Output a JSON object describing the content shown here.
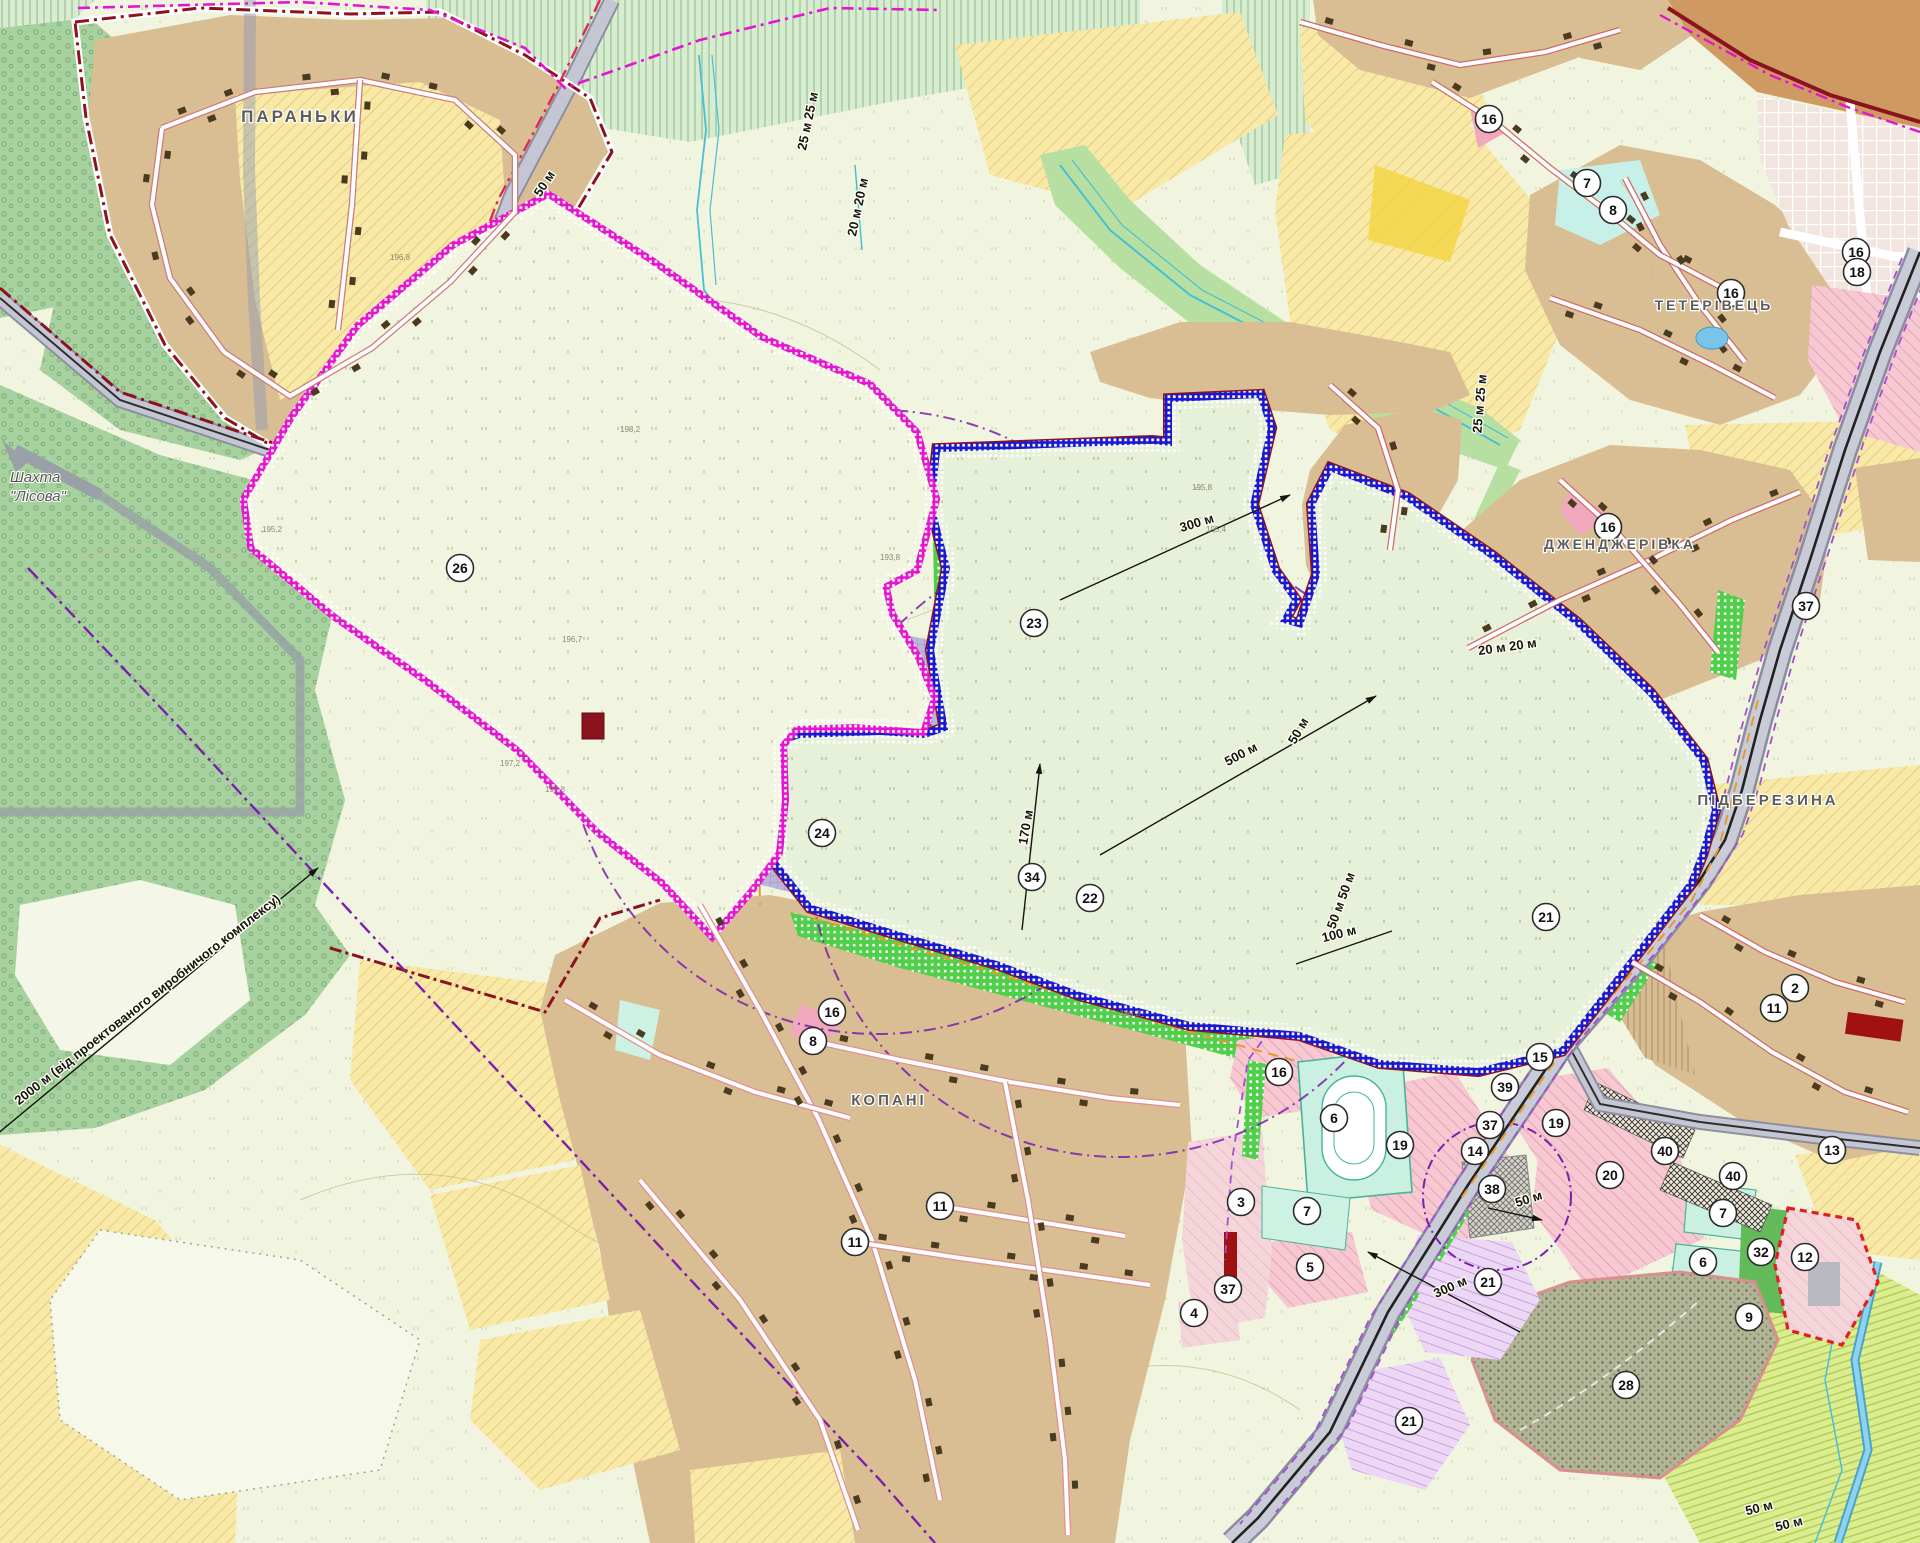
{
  "map": {
    "places": [
      {
        "name": "paranky",
        "text": "ПАРАНЬКИ",
        "x": 300,
        "y": 122,
        "size": 17
      },
      {
        "name": "teterivets",
        "text": "ТЕТЕРІВЕЦЬ",
        "x": 1714,
        "y": 310,
        "size": 14
      },
      {
        "name": "dzhendzherivka",
        "text": "ДЖЕНДЖЕРІВКА",
        "x": 1620,
        "y": 549,
        "size": 14
      },
      {
        "name": "pidberezyna",
        "text": "ПІДБЕРЕЗИНА",
        "x": 1768,
        "y": 805,
        "size": 15
      },
      {
        "name": "kopani",
        "text": "КОПАНІ",
        "x": 889,
        "y": 1105,
        "size": 15
      }
    ],
    "mine_label": {
      "lines": [
        "Шахта",
        "\"Лісова\""
      ],
      "x": 10,
      "y": 482
    },
    "annotations": [
      {
        "text": "50 м",
        "x": 548,
        "y": 186,
        "rot": -57
      },
      {
        "text": "25 м 25 м",
        "x": 812,
        "y": 122,
        "rot": -78
      },
      {
        "text": "20 м 20 м",
        "x": 862,
        "y": 208,
        "rot": -78
      },
      {
        "text": "25 м 25 м",
        "x": 1484,
        "y": 404,
        "rot": -85
      },
      {
        "text": "20 м 20 м",
        "x": 1508,
        "y": 651,
        "rot": -8
      },
      {
        "text": "300 м",
        "x": 1198,
        "y": 527,
        "rot": -17,
        "line": [
          1060,
          600,
          1290,
          495
        ],
        "arrow": true
      },
      {
        "text": "500 м",
        "x": 1243,
        "y": 758,
        "rot": -28,
        "line": [
          1100,
          855,
          1376,
          696
        ],
        "arrow": true
      },
      {
        "text": "170 м",
        "x": 1030,
        "y": 828,
        "rot": -80,
        "line": [
          1022,
          930,
          1040,
          764
        ],
        "arrow": true
      },
      {
        "text": "100 м",
        "x": 1340,
        "y": 938,
        "rot": -14,
        "line": [
          1296,
          964,
          1392,
          931
        ]
      },
      {
        "text": "50 м 50 м",
        "x": 1345,
        "y": 902,
        "rot": -70
      },
      {
        "text": "50 м",
        "x": 1302,
        "y": 733,
        "rot": -60
      },
      {
        "text": "50 м",
        "x": 1530,
        "y": 1203,
        "rot": -18,
        "line": [
          1488,
          1208,
          1542,
          1220
        ],
        "arrow": true
      },
      {
        "text": "300 м",
        "x": 1452,
        "y": 1291,
        "rot": -24,
        "line": [
          1520,
          1332,
          1368,
          1252
        ],
        "arrow": true
      },
      {
        "text": "50 м",
        "x": 1760,
        "y": 1512,
        "rot": -14
      },
      {
        "text": "50 м",
        "x": 1790,
        "y": 1528,
        "rot": -14
      },
      {
        "text": "2000 м (від проектованого виробничого комплексу)",
        "x": 150,
        "y": 1003,
        "rot": -38,
        "line": [
          -10,
          1140,
          318,
          868
        ],
        "arrow": true
      }
    ],
    "zone_markers": [
      {
        "n": "16",
        "x": 1489,
        "y": 119
      },
      {
        "n": "7",
        "x": 1587,
        "y": 183
      },
      {
        "n": "8",
        "x": 1613,
        "y": 210
      },
      {
        "n": "16",
        "x": 1731,
        "y": 293
      },
      {
        "n": "16",
        "x": 1856,
        "y": 252
      },
      {
        "n": "18",
        "x": 1857,
        "y": 272
      },
      {
        "n": "37",
        "x": 1806,
        "y": 606
      },
      {
        "n": "16",
        "x": 1608,
        "y": 527
      },
      {
        "n": "23",
        "x": 1034,
        "y": 623
      },
      {
        "n": "26",
        "x": 460,
        "y": 568
      },
      {
        "n": "24",
        "x": 822,
        "y": 833
      },
      {
        "n": "34",
        "x": 1032,
        "y": 877
      },
      {
        "n": "22",
        "x": 1090,
        "y": 898
      },
      {
        "n": "21",
        "x": 1546,
        "y": 917
      },
      {
        "n": "16",
        "x": 832,
        "y": 1012
      },
      {
        "n": "8",
        "x": 813,
        "y": 1041
      },
      {
        "n": "11",
        "x": 940,
        "y": 1206
      },
      {
        "n": "11",
        "x": 855,
        "y": 1242
      },
      {
        "n": "2",
        "x": 1795,
        "y": 988
      },
      {
        "n": "11",
        "x": 1774,
        "y": 1008
      },
      {
        "n": "13",
        "x": 1832,
        "y": 1150
      },
      {
        "n": "15",
        "x": 1540,
        "y": 1057
      },
      {
        "n": "39",
        "x": 1505,
        "y": 1087
      },
      {
        "n": "16",
        "x": 1279,
        "y": 1072
      },
      {
        "n": "6",
        "x": 1334,
        "y": 1118
      },
      {
        "n": "3",
        "x": 1241,
        "y": 1202
      },
      {
        "n": "7",
        "x": 1307,
        "y": 1211
      },
      {
        "n": "5",
        "x": 1310,
        "y": 1267
      },
      {
        "n": "4",
        "x": 1194,
        "y": 1313
      },
      {
        "n": "37",
        "x": 1228,
        "y": 1289
      },
      {
        "n": "19",
        "x": 1400,
        "y": 1145
      },
      {
        "n": "37",
        "x": 1490,
        "y": 1125
      },
      {
        "n": "14",
        "x": 1475,
        "y": 1151
      },
      {
        "n": "19",
        "x": 1556,
        "y": 1123
      },
      {
        "n": "38",
        "x": 1492,
        "y": 1189
      },
      {
        "n": "20",
        "x": 1610,
        "y": 1175
      },
      {
        "n": "40",
        "x": 1665,
        "y": 1151
      },
      {
        "n": "40",
        "x": 1733,
        "y": 1176
      },
      {
        "n": "7",
        "x": 1723,
        "y": 1213
      },
      {
        "n": "6",
        "x": 1703,
        "y": 1262
      },
      {
        "n": "32",
        "x": 1761,
        "y": 1252
      },
      {
        "n": "12",
        "x": 1805,
        "y": 1257
      },
      {
        "n": "9",
        "x": 1749,
        "y": 1317
      },
      {
        "n": "28",
        "x": 1626,
        "y": 1385
      },
      {
        "n": "21",
        "x": 1488,
        "y": 1282
      },
      {
        "n": "21",
        "x": 1409,
        "y": 1421
      }
    ],
    "spot_heights": [
      {
        "t": "196,8",
        "x": 390,
        "y": 260
      },
      {
        "t": "198,2",
        "x": 620,
        "y": 432
      },
      {
        "t": "195,2",
        "x": 262,
        "y": 532
      },
      {
        "t": "196,7",
        "x": 562,
        "y": 642
      },
      {
        "t": "197,2",
        "x": 500,
        "y": 766
      },
      {
        "t": "197,8",
        "x": 545,
        "y": 792
      },
      {
        "t": "195,8",
        "x": 1192,
        "y": 490
      },
      {
        "t": "195,4",
        "x": 1206,
        "y": 532
      },
      {
        "t": "196,3",
        "x": 1120,
        "y": 1016
      },
      {
        "t": "193,8",
        "x": 880,
        "y": 560
      }
    ],
    "colors": {
      "boundary_magenta": "#e614d2",
      "boundary_blue": "#1a17cf",
      "village_boundary_darkred": "#8c1220",
      "sanitary_purple": "#7b1fae",
      "forest_green": "#a7d19e",
      "field_yellow": "#f8e9a6",
      "village_tan": "#d9bd93",
      "industrial_lavender": "#bcb5da",
      "greenery_dotted": "#50cf4a",
      "water_blue": "#6cc3e8",
      "zone_pink": "#f5c8d2"
    }
  }
}
